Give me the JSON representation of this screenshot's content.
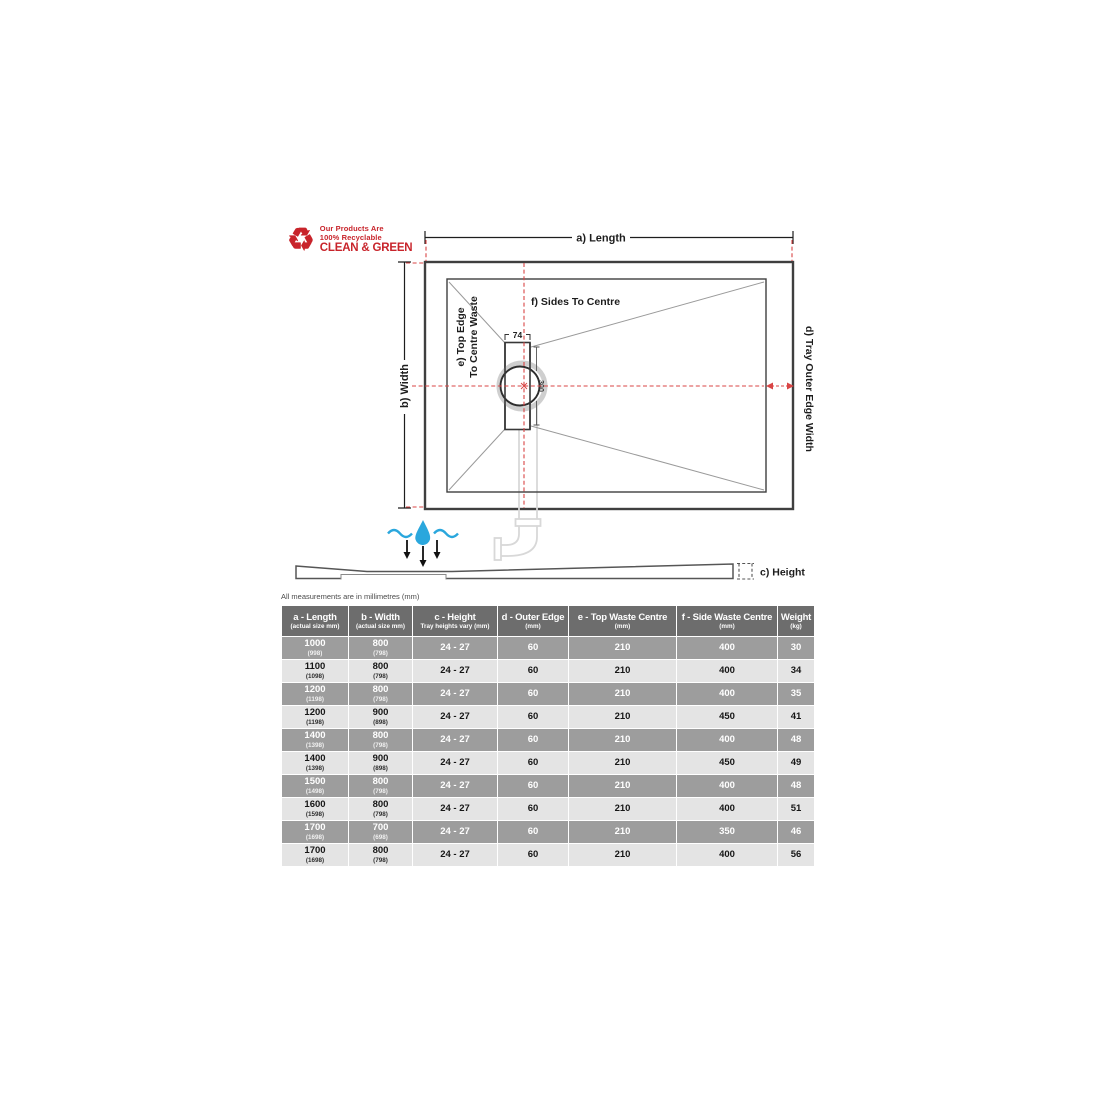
{
  "logo": {
    "line1": "Our Products Are",
    "line2": "100% Recyclable",
    "line3": "CLEAN & GREEN",
    "icon": "recycle-icon",
    "color": "#c8242b"
  },
  "diagram": {
    "labels": {
      "a_length": "a) Length",
      "b_width": "b) Width",
      "c_height": "c) Height",
      "d_outer": "d) Tray Outer Edge Width",
      "e_top_1": "e) Top Edge",
      "e_top_2": "To Centre Waste",
      "f_sides": "f) Sides To Centre",
      "dim74": "74",
      "dim300": "300"
    },
    "colors": {
      "line_dark": "#3f3f3f",
      "diagonal_gray": "#9a9a9a",
      "guide_red": "#d94545",
      "pipe_gray": "#d8d8d8",
      "water_blue": "#2aa7dd"
    }
  },
  "table": {
    "note": "All measurements are in millimetres (mm)",
    "columns": [
      {
        "label": "a - Length",
        "sub": "(actual size mm)"
      },
      {
        "label": "b - Width",
        "sub": "(actual size mm)"
      },
      {
        "label": "c - Height",
        "sub": "Tray heights vary (mm)"
      },
      {
        "label": "d - Outer Edge",
        "sub": "(mm)"
      },
      {
        "label": "e - Top Waste Centre",
        "sub": "(mm)"
      },
      {
        "label": "f - Side Waste Centre",
        "sub": "(mm)"
      },
      {
        "label": "Weight",
        "sub": "(kg)"
      }
    ],
    "rows": [
      {
        "length": "1000",
        "length_actual": "(998)",
        "width": "800",
        "width_actual": "(798)",
        "height": "24 - 27",
        "outer_edge": "60",
        "top_waste": "210",
        "side_waste": "400",
        "weight": "30"
      },
      {
        "length": "1100",
        "length_actual": "(1098)",
        "width": "800",
        "width_actual": "(798)",
        "height": "24 - 27",
        "outer_edge": "60",
        "top_waste": "210",
        "side_waste": "400",
        "weight": "34"
      },
      {
        "length": "1200",
        "length_actual": "(1198)",
        "width": "800",
        "width_actual": "(798)",
        "height": "24 - 27",
        "outer_edge": "60",
        "top_waste": "210",
        "side_waste": "400",
        "weight": "35"
      },
      {
        "length": "1200",
        "length_actual": "(1198)",
        "width": "900",
        "width_actual": "(898)",
        "height": "24 - 27",
        "outer_edge": "60",
        "top_waste": "210",
        "side_waste": "450",
        "weight": "41"
      },
      {
        "length": "1400",
        "length_actual": "(1398)",
        "width": "800",
        "width_actual": "(798)",
        "height": "24 - 27",
        "outer_edge": "60",
        "top_waste": "210",
        "side_waste": "400",
        "weight": "48"
      },
      {
        "length": "1400",
        "length_actual": "(1398)",
        "width": "900",
        "width_actual": "(898)",
        "height": "24 - 27",
        "outer_edge": "60",
        "top_waste": "210",
        "side_waste": "450",
        "weight": "49"
      },
      {
        "length": "1500",
        "length_actual": "(1498)",
        "width": "800",
        "width_actual": "(798)",
        "height": "24 - 27",
        "outer_edge": "60",
        "top_waste": "210",
        "side_waste": "400",
        "weight": "48"
      },
      {
        "length": "1600",
        "length_actual": "(1598)",
        "width": "800",
        "width_actual": "(798)",
        "height": "24 - 27",
        "outer_edge": "60",
        "top_waste": "210",
        "side_waste": "400",
        "weight": "51"
      },
      {
        "length": "1700",
        "length_actual": "(1698)",
        "width": "700",
        "width_actual": "(698)",
        "height": "24 - 27",
        "outer_edge": "60",
        "top_waste": "210",
        "side_waste": "350",
        "weight": "46"
      },
      {
        "length": "1700",
        "length_actual": "(1698)",
        "width": "800",
        "width_actual": "(798)",
        "height": "24 - 27",
        "outer_edge": "60",
        "top_waste": "210",
        "side_waste": "400",
        "weight": "56"
      }
    ],
    "row_shading": [
      "dark",
      "light",
      "dark",
      "light",
      "dark",
      "light",
      "dark",
      "light",
      "dark",
      "light"
    ],
    "header_bg": "#6d6d6d",
    "dark_row_bg": "#9d9d9d",
    "light_row_bg": "#e4e4e4"
  }
}
